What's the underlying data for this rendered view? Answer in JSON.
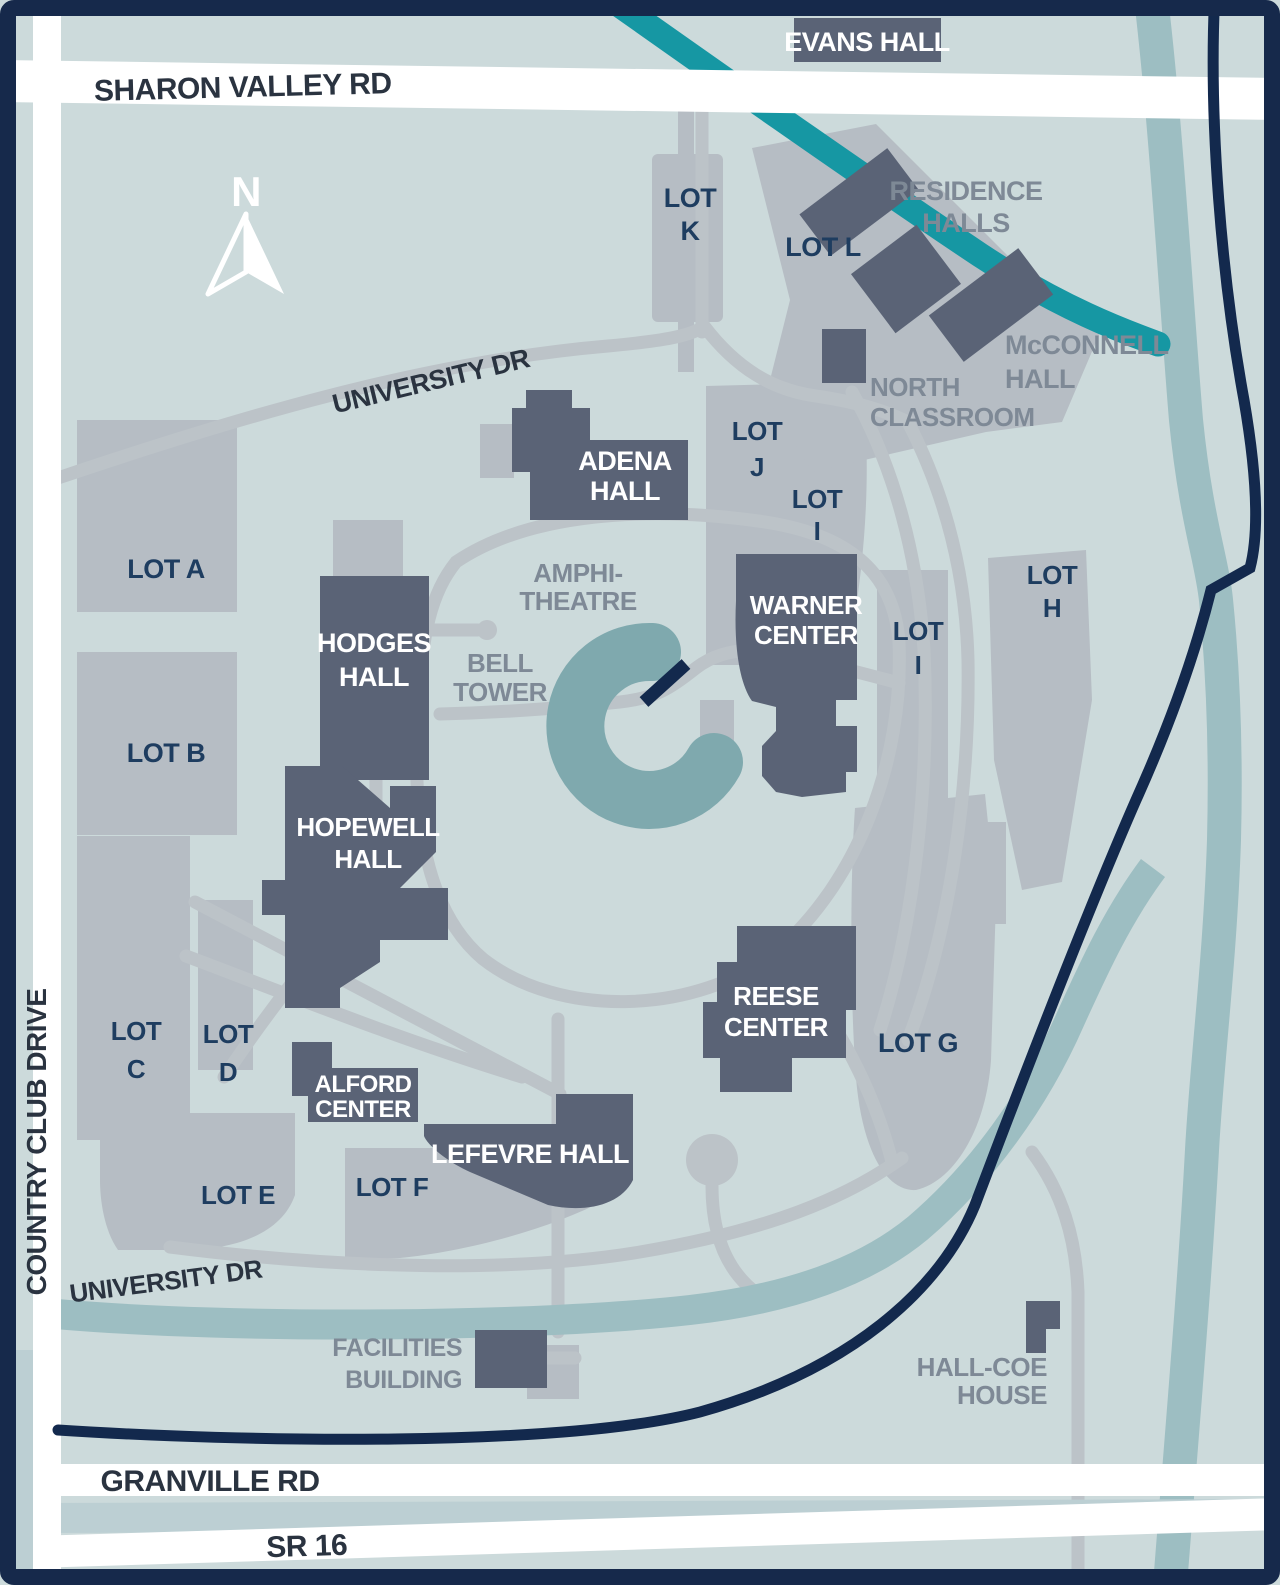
{
  "map": {
    "north_label": "N",
    "roads": {
      "sharon_valley": "SHARON VALLEY RD",
      "country_club": "COUNTRY CLUB DRIVE",
      "granville": "GRANVILLE RD",
      "sr_16": "SR 16",
      "university_dr_top": "UNIVERSITY DR",
      "university_dr_bottom": "UNIVERSITY DR"
    },
    "buildings": {
      "evans": "EVANS HALL",
      "adena_l1": "ADENA",
      "adena_l2": "HALL",
      "hodges_l1": "HODGES",
      "hodges_l2": "HALL",
      "warner_l1": "WARNER",
      "warner_l2": "CENTER",
      "hopewell_l1": "HOPEWELL",
      "hopewell_l2": "HALL",
      "alford_l1": "ALFORD",
      "alford_l2": "CENTER",
      "lefevre": "LEFEVRE HALL",
      "reese_l1": "REESE",
      "reese_l2": "CENTER",
      "residence_l1": "RESIDENCE",
      "residence_l2": "HALLS",
      "mcconnell_l1": "McCONNELL",
      "mcconnell_l2": "HALL",
      "north_classroom_l1": "NORTH",
      "north_classroom_l2": "CLASSROOM",
      "facilities_l1": "FACILITIES",
      "facilities_l2": "BUILDING",
      "hall_coe_l1": "HALL-COE",
      "hall_coe_l2": "HOUSE"
    },
    "landmarks": {
      "amphitheatre_l1": "AMPHI-",
      "amphitheatre_l2": "THEATRE",
      "bell_tower_l1": "BELL",
      "bell_tower_l2": "TOWER"
    },
    "lots": {
      "a": "LOT A",
      "b": "LOT B",
      "c_l1": "LOT",
      "c_l2": "C",
      "d_l1": "LOT",
      "d_l2": "D",
      "e": "LOT E",
      "f": "LOT F",
      "g": "LOT G",
      "h_l1": "LOT",
      "h_l2": "H",
      "i_upper_l1": "LOT",
      "i_upper_l2": "I",
      "i_lower_l1": "LOT",
      "i_lower_l2": "I",
      "j_l1": "LOT",
      "j_l2": "J",
      "k_l1": "LOT",
      "k_l2": "K",
      "l": "LOT L"
    },
    "colors": {
      "background": "#ccdadb",
      "border_navy": "#16294b",
      "building_slate": "#5a6376",
      "lot_gray": "#b6bdc4",
      "path_gray": "#bcc3c8",
      "road_white": "#ffffff",
      "creek_teal": "#1697a3",
      "river_muted": "#9dbec2",
      "pond": "#7fa9ae",
      "navy_road": "#13294d",
      "lot_label": "#1e3d60",
      "gray_label": "#7e8996",
      "road_label": "#2a3340"
    }
  }
}
